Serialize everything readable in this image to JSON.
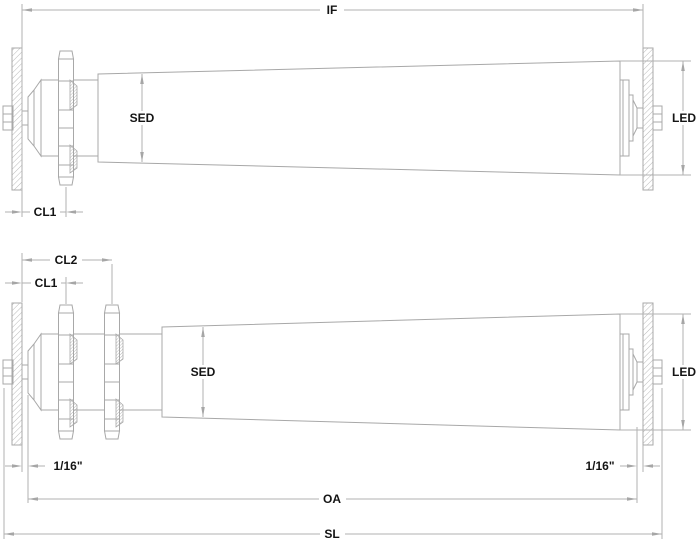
{
  "drawing": {
    "colors": {
      "background": "#ffffff",
      "geometry_line": "#a8a8a8",
      "dimension_line": "#b2b2b2",
      "label_text": "#141414"
    },
    "top_view": {
      "if": "IF",
      "sed": "SED",
      "led": "LED",
      "cl1": "CL1"
    },
    "bottom_view": {
      "cl2": "CL2",
      "cl1": "CL1",
      "sed": "SED",
      "led": "LED",
      "gap_left": "1/16\"",
      "gap_right": "1/16\"",
      "oa": "OA",
      "sl": "SL"
    }
  }
}
